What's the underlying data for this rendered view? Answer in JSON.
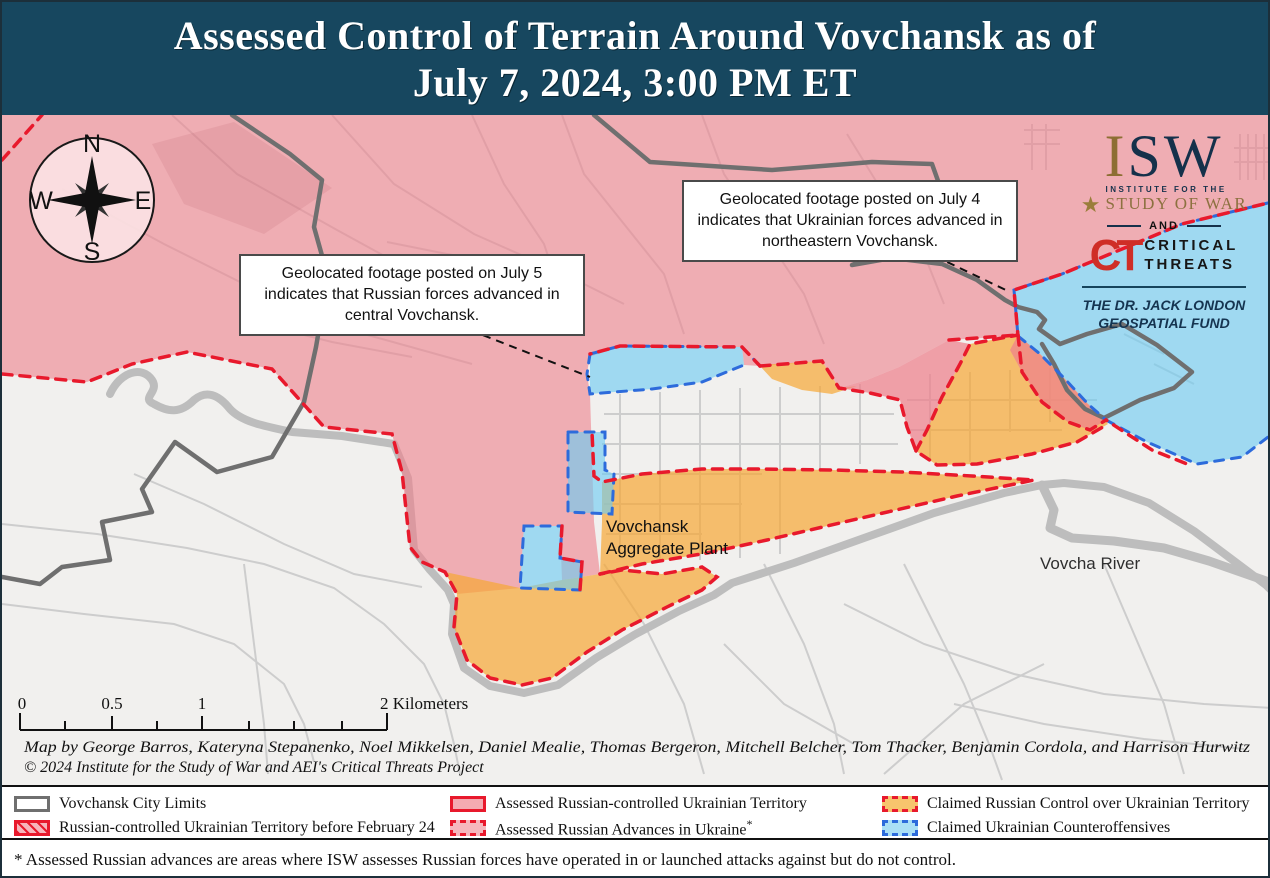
{
  "title": {
    "line1": "Assessed Control of Terrain Around Vovchansk as of",
    "line2": "July 7, 2024, 3:00 PM ET"
  },
  "colors": {
    "header_bg": "#17475f",
    "russian_controlled_pink": "#f2a6ad",
    "claimed_russian_orange": "#f7c46d",
    "claimed_ukrainian_blue": "#aadff5",
    "russian_advance_dash_red": "#e8192c",
    "ukrainian_dash_blue": "#2d6bdb",
    "city_limits_gray": "#6f6f6f"
  },
  "compass": {
    "n": "N",
    "e": "E",
    "s": "S",
    "w": "W"
  },
  "logo": {
    "isw": "ISW",
    "institute": "INSTITUTE FOR THE",
    "study": "STUDY OF WAR",
    "and": "AND",
    "ct": "CT",
    "critical": "CRITICAL",
    "threats": "THREATS",
    "fund_line1": "THE DR. JACK LONDON",
    "fund_line2": "GEOSPATIAL FUND"
  },
  "annotations": {
    "july4": "Geolocated footage posted on July 4 indicates that Ukrainian forces advanced in northeastern Vovchansk.",
    "july5": "Geolocated footage posted on July 5 indicates that Russian forces advanced in central Vovchansk."
  },
  "map_labels": {
    "aggregate_line1": "Vovchansk",
    "aggregate_line2": "Aggregate Plant",
    "river": "Vovcha River"
  },
  "scale": {
    "t0": "0",
    "t05": "0.5",
    "t1": "1",
    "t2": "2 Kilometers"
  },
  "credits": {
    "line1": "Map by George Barros, Kateryna Stepanenko, Noel Mikkelsen, Daniel Mealie, Thomas Bergeron, Mitchell Belcher, Tom Thacker, Benjamin Cordola, and Harrison Hurwitz",
    "line2": "© 2024 Institute for the Study of War and AEI's Critical Threats Project"
  },
  "legend": {
    "items": [
      {
        "label": "Vovchansk City Limits",
        "sup": ""
      },
      {
        "label": "Russian-controlled Ukrainian Territory before February 24",
        "sup": ""
      },
      {
        "label": "Assessed Russian-controlled Ukrainian Territory",
        "sup": ""
      },
      {
        "label": "Assessed Russian Advances in Ukraine",
        "sup": "*"
      },
      {
        "label": "Claimed Russian Control over Ukrainian Territory",
        "sup": ""
      },
      {
        "label": "Claimed Ukrainian Counteroffensives",
        "sup": ""
      }
    ]
  },
  "footnote": "* Assessed Russian advances are areas where ISW assesses Russian forces have operated in or launched attacks against but do not control."
}
